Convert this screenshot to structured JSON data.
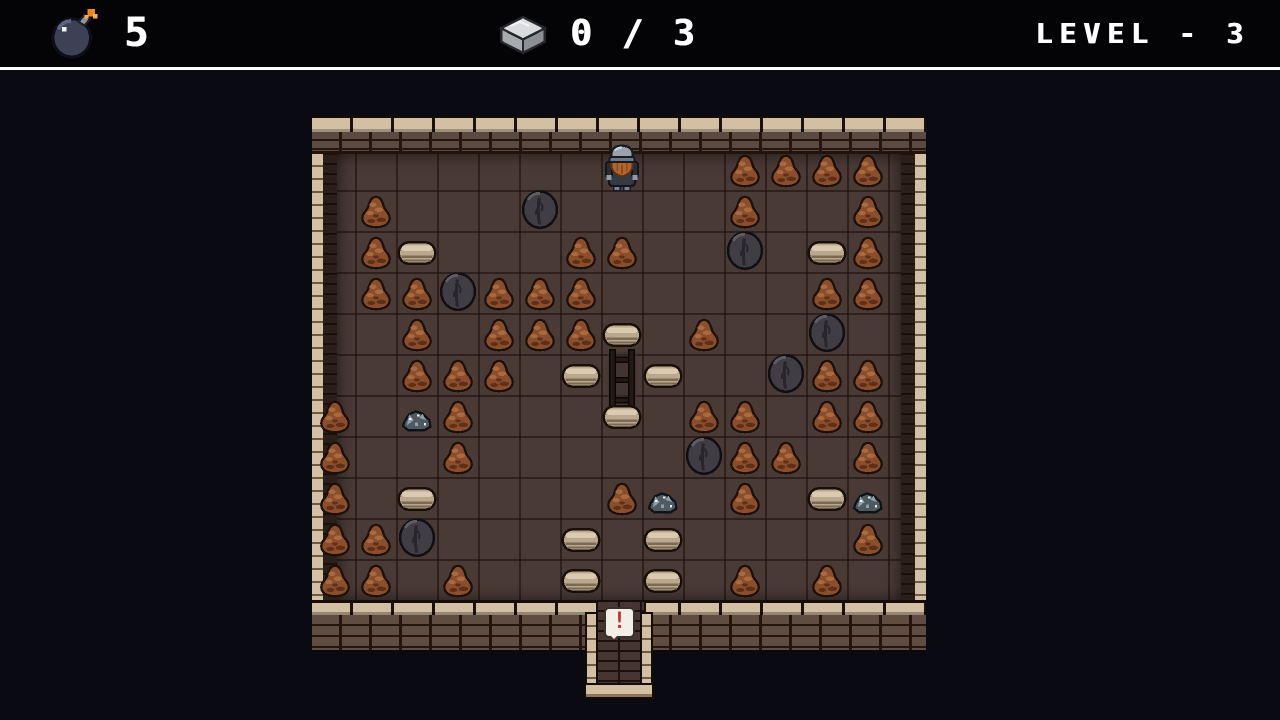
{
  "palette": {
    "bg_play": "#0a0a13",
    "hud_bg": "#040406",
    "hud_text": "#ffffff",
    "divider": "#ffffff",
    "floor": "#4a3a36",
    "tan": "#d3c0a4",
    "brick": "#5b4a41",
    "brick_mortar": "#24150e",
    "dirt": "#8a4e2c",
    "dirt_hi": "#aa6a3e",
    "dirt_lo": "#5e3017",
    "boulder": "#403e44",
    "boulder_hi": "#5d5b64",
    "boulder_lo": "#28262c",
    "rubble": "#4e5960",
    "rubble_hi": "#8fa0aa",
    "sparkle": "#e6eef2",
    "slab": "#b9a88e",
    "slab_hi": "#d9cab0",
    "slab_lo": "#7c6a54",
    "gate": "#241a13",
    "player_helmet": "#9aa2ac",
    "player_beard": "#b2652c",
    "player_body": "#333a44",
    "bomb_body": "#3d4156",
    "spark": "#f1861d",
    "stone_top": "#d9dbdc",
    "stone_left": "#a8abae",
    "stone_right": "#8c8f93",
    "sign_red": "#bf3a30"
  },
  "hud": {
    "bomb_counter": {
      "icon": "bomb-icon",
      "count": "5"
    },
    "stone_counter": {
      "icon": "stone-icon",
      "value": "0 / 3"
    },
    "level_indicator": "LEVEL - 3"
  },
  "exit": {
    "sign": "!"
  },
  "board": {
    "cols": 14,
    "rows": 11,
    "cell": 41,
    "origin": [
      2,
      34
    ],
    "legend": {
      ".": "empty-floor",
      "d": "dirt-mound",
      "b": "boulder",
      "r": "ore-rubble",
      "s": "stone-slab",
      "g": "gate",
      "p": "player"
    },
    "grid": [
      ".......p..dddd",
      ".d...b....d..d",
      ".ds...dd..b.sd",
      ".ddbddd.....dd",
      "..d.ddds.d..b.",
      "..ddd.sgs..bdd",
      "d.rd...s.dd.dd",
      "d..d.....bdd.d",
      "d.s....dr.d.sr",
      "ddb...s.s....d",
      "dd.d..s.s.d.d."
    ]
  }
}
